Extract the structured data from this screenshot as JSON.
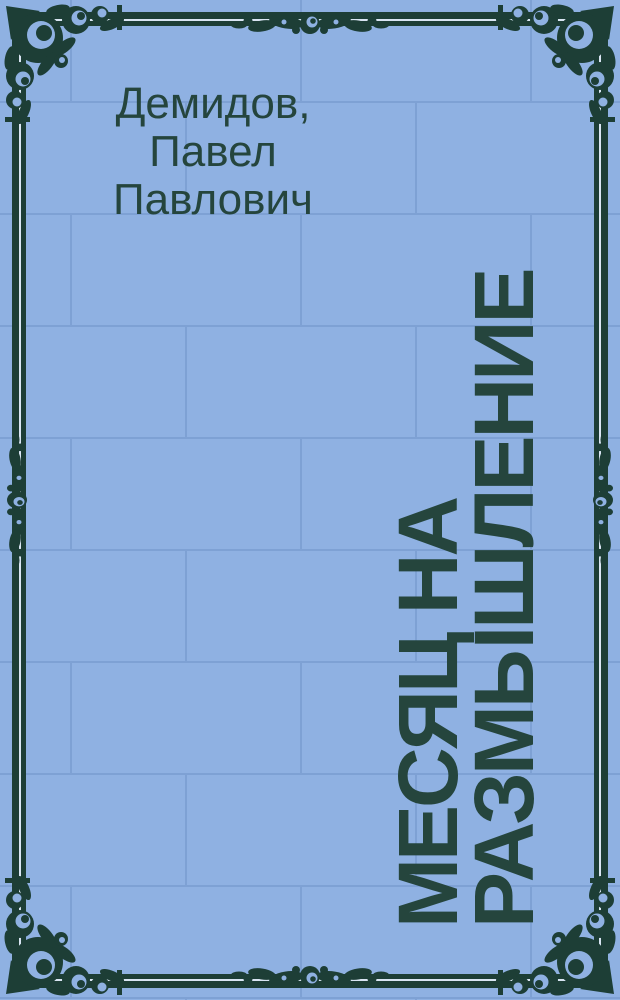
{
  "cover": {
    "type_label": "book-cover-placeholder",
    "author": {
      "full": "Демидов, Павел Павлович",
      "lines": [
        "Демидов,",
        "Павел",
        "Павлович"
      ]
    },
    "title": {
      "full": "МЕСЯЦ НА РАЗМЫШЛЕНИЕ",
      "lines": [
        "МЕСЯЦ НА",
        "РАЗМЫШЛЕНИЕ"
      ],
      "orientation": "rotated-90-ccw-bottom-to-top"
    },
    "colors": {
      "background_blue": "#8fb1e2",
      "brick_line_blue": "#7ea1d4",
      "ornament_green": "#1d3e36",
      "text_green": "#25453d",
      "frame_gap_light": "#d9e5f3"
    }
  }
}
